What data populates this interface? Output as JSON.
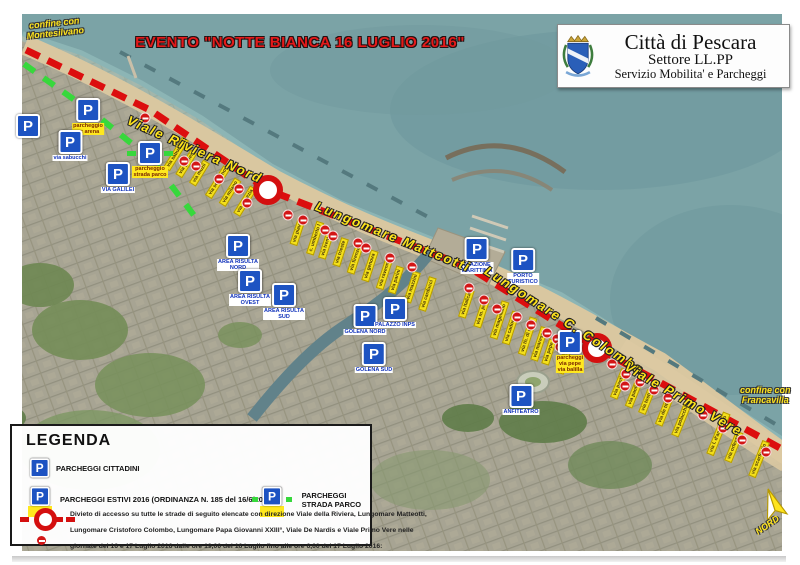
{
  "title": "EVENTO \"NOTTE BIANCA 16 LUGLIO 2016\"",
  "header": {
    "line1": "Città di Pescara",
    "line2": "Settore  LL.PP",
    "line3": "Servizio Mobilita' e  Parcheggi"
  },
  "boundaries": {
    "nw": "confine con\nMontesilvano",
    "se": "confine con\nFrancavilla"
  },
  "north_label": "NORD",
  "parking_glyph": "P",
  "colors": {
    "route_red": "#dc0e0e",
    "parco_green": "#37d83c",
    "sign_blue": "#1d53c2",
    "label_yellow": "#ffe41c",
    "sea": "#7ba3a6",
    "sand": "#d9c7a0"
  },
  "road_labels": [
    {
      "x": 128,
      "y": 112,
      "r": 24,
      "label": "Viale Riviera Nord"
    },
    {
      "x": 316,
      "y": 198,
      "r": 22,
      "label": "Lungomare Matteotti"
    },
    {
      "x": 486,
      "y": 262,
      "r": 33,
      "label": "Lungomare C. Colombo"
    },
    {
      "x": 626,
      "y": 358,
      "r": 30,
      "label": "Viale Primo Vere"
    }
  ],
  "rings": [
    [
      268,
      190
    ],
    [
      597,
      348
    ]
  ],
  "parkings": [
    {
      "x": 88,
      "y": 98,
      "t": "summer",
      "cap": "parcheggio\nex arena"
    },
    {
      "x": 28,
      "y": 114,
      "t": "city",
      "cap": ""
    },
    {
      "x": 70,
      "y": 130,
      "t": "city",
      "cap": "via sabucchi"
    },
    {
      "x": 150,
      "y": 141,
      "t": "parco",
      "cap": "parcheggio\nstrada parco"
    },
    {
      "x": 118,
      "y": 162,
      "t": "city",
      "cap": "VIA GALILEI"
    },
    {
      "x": 238,
      "y": 234,
      "t": "city",
      "cap": "AREA RISULTA\nNORD"
    },
    {
      "x": 250,
      "y": 269,
      "t": "city",
      "cap": "AREA RISULTA\nOVEST"
    },
    {
      "x": 284,
      "y": 283,
      "t": "city",
      "cap": "AREA RISULTA\nSUD"
    },
    {
      "x": 365,
      "y": 304,
      "t": "city",
      "cap": "GOLENA NORD"
    },
    {
      "x": 395,
      "y": 297,
      "t": "city",
      "cap": "PALAZZO INPS"
    },
    {
      "x": 374,
      "y": 342,
      "t": "city",
      "cap": "GOLENA SUD"
    },
    {
      "x": 477,
      "y": 237,
      "t": "city",
      "cap": "STAZIONE\nMARITTIMA"
    },
    {
      "x": 523,
      "y": 248,
      "t": "city",
      "cap": "PORTO\nTURISTICO"
    },
    {
      "x": 570,
      "y": 330,
      "t": "summer",
      "cap": "parcheggi\nvia pepe\nvia balilla"
    },
    {
      "x": 521,
      "y": 384,
      "t": "city",
      "cap": "ANFITEATRO"
    }
  ],
  "no_entry": [
    [
      145,
      118
    ],
    [
      184,
      161
    ],
    [
      196,
      166
    ],
    [
      219,
      179
    ],
    [
      239,
      189
    ],
    [
      247,
      203
    ],
    [
      288,
      215
    ],
    [
      303,
      220
    ],
    [
      325,
      230
    ],
    [
      333,
      236
    ],
    [
      358,
      243
    ],
    [
      366,
      248
    ],
    [
      390,
      258
    ],
    [
      412,
      267
    ],
    [
      469,
      288
    ],
    [
      484,
      300
    ],
    [
      497,
      309
    ],
    [
      517,
      317
    ],
    [
      531,
      325
    ],
    [
      547,
      333
    ],
    [
      557,
      339
    ],
    [
      560,
      347
    ],
    [
      612,
      364
    ],
    [
      626,
      374
    ],
    [
      640,
      382
    ],
    [
      654,
      390
    ],
    [
      668,
      398
    ],
    [
      625,
      386
    ],
    [
      703,
      415
    ],
    [
      723,
      428
    ],
    [
      742,
      440
    ],
    [
      766,
      452
    ]
  ],
  "streets": [
    [
      158,
      150,
      -58,
      "via sabucchi"
    ],
    [
      172,
      160,
      -58,
      "via galilei"
    ],
    [
      186,
      169,
      -58,
      "via muzii"
    ],
    [
      200,
      178,
      -58,
      "via solferino"
    ],
    [
      215,
      188,
      -58,
      "via milano"
    ],
    [
      229,
      197,
      -58,
      "via venezia"
    ],
    [
      284,
      228,
      -72,
      "via piave"
    ],
    [
      298,
      234,
      -72,
      "c. umberto I"
    ],
    [
      312,
      241,
      -72,
      "via trento"
    ],
    [
      326,
      248,
      -72,
      "via trieste"
    ],
    [
      340,
      255,
      -72,
      "via firenze"
    ],
    [
      354,
      262,
      -72,
      "via genova"
    ],
    [
      368,
      269,
      -72,
      "via ravenna"
    ],
    [
      382,
      276,
      -72,
      "via parini"
    ],
    [
      396,
      283,
      -72,
      "via mazzini"
    ],
    [
      410,
      290,
      -72,
      "via carducci"
    ],
    [
      452,
      300,
      -72,
      "via italica"
    ],
    [
      466,
      308,
      -72,
      "via m. polo"
    ],
    [
      480,
      316,
      -72,
      "via magellano"
    ],
    [
      494,
      324,
      -72,
      "via cadorna"
    ],
    [
      508,
      332,
      -72,
      "via th. di revel"
    ],
    [
      522,
      340,
      -72,
      "via maresca"
    ],
    [
      536,
      348,
      -72,
      "via pepe"
    ],
    [
      550,
      356,
      -72,
      "via balilla"
    ],
    [
      604,
      380,
      -68,
      "via pantini"
    ],
    [
      619,
      389,
      -68,
      "via paolini"
    ],
    [
      634,
      398,
      -68,
      "via tosti"
    ],
    [
      649,
      407,
      -68,
      "via de titta"
    ],
    [
      664,
      416,
      -68,
      "via polacchi"
    ],
    [
      696,
      430,
      -68,
      "via l. d'annunzio"
    ],
    [
      718,
      443,
      -68,
      "via orfento"
    ],
    [
      740,
      455,
      -68,
      "via scarfoglio"
    ]
  ],
  "legend": {
    "title": "LEGENDA",
    "item_city": "PARCHEGGI CITTADINI",
    "item_summer": "PARCHEGGI ESTIVI 2016 (ORDINANZA N. 185 del 16/6/2016)",
    "item_parco": "PARCHEGGI STRADA PARCO",
    "divieto_line1": "Divieto di accesso su tutte le strade di seguito elencate con direzione Viale della Riviera, Lungomare Matteotti,",
    "divieto_line2": "Lungomare Cristoforo Colombo, Lungomare Papa Giovanni XXIII°, Viale De Nardis e Viale Primo Vere nelle",
    "divieto_line3": "giornate del 16 e 17 Luglio 2016 dalle ore 19,00 del 16 Luglio fino alle ore 6,00 del 17 Luglio 2016:"
  }
}
